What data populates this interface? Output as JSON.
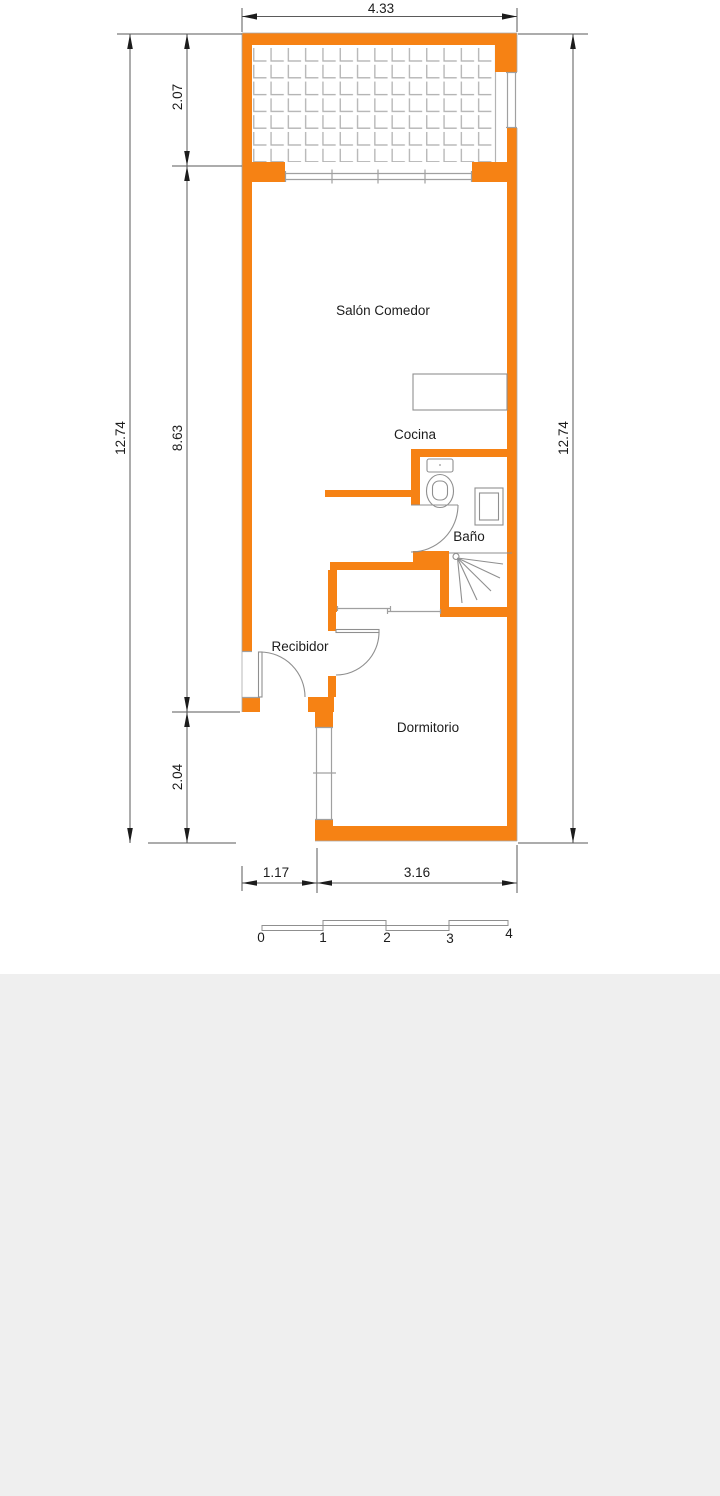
{
  "rooms": {
    "salon": "Salón Comedor",
    "cocina": "Cocina",
    "bano": "Baño",
    "recibidor": "Recibidor",
    "dormitorio": "Dormitorio"
  },
  "dimensions": {
    "top_width": "4.33",
    "left_total": "12.74",
    "left_top": "2.07",
    "left_middle": "8.63",
    "left_bottom": "2.04",
    "right_total": "12.74",
    "bottom_left": "1.17",
    "bottom_right": "3.16"
  },
  "scale_bar": {
    "t0": "0",
    "t1": "1",
    "t2": "2",
    "t3": "3",
    "t4": "4"
  },
  "colors": {
    "wall": "#F68214",
    "dimension_line": "#5a5a5a",
    "fixture_line": "#8f8f8f",
    "tile_line": "#b3b3b3",
    "lower_background": "#efefef"
  }
}
